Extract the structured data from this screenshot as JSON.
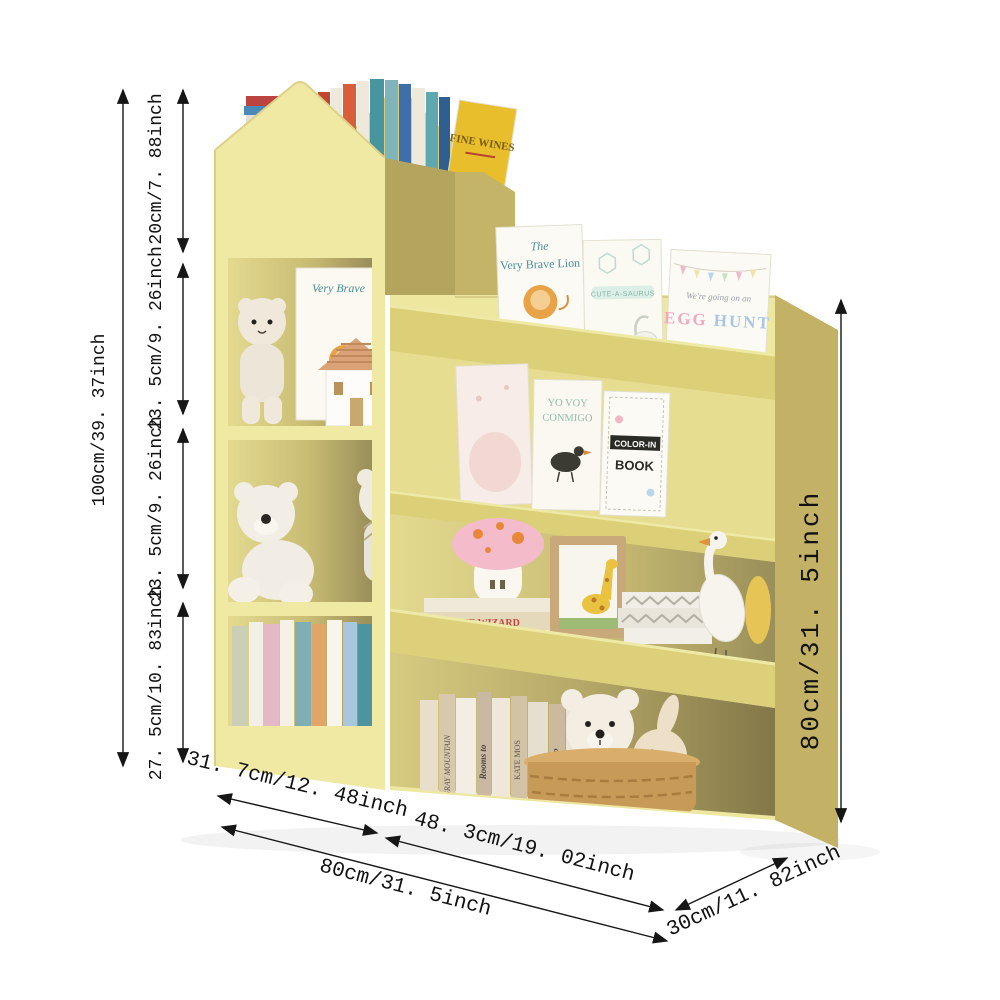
{
  "image": {
    "kind": "kids bookshelf product dimension illustration",
    "background": "#ffffff"
  },
  "colors": {
    "shelf_front": "#EFE9A4",
    "shelf_lip": "#DBCF78",
    "shelf_side": "#C3B166",
    "cubby_shadow": "#9A8E5A",
    "dimension_line": "#161616"
  },
  "dimensions": {
    "left_total_height": "100cm/39. 37inch",
    "top_section_height": "20cm/7. 88inch",
    "upper_shelf_height": "23. 5cm/9. 26inch",
    "middle_shelf_height": "23. 5cm/9. 26inch",
    "bottom_shelf_height": "27. 5cm/10. 83inch",
    "left_unit_width": "31. 7cm/12. 48inch",
    "right_unit_width": "48. 3cm/19. 02inch",
    "total_width": "80cm/31. 5inch",
    "right_unit_height": "80cm/31. 5inch",
    "depth": "30cm/11. 82inch"
  },
  "books": {
    "attic_title": "FINE WINES",
    "cubby1_book_title": "Very Brave",
    "tier1_book1_line1": "The",
    "tier1_book1_line2": "Very Brave Lion",
    "tier1_book2_banner": "CUTE-A-SAURUS",
    "tier1_book3_line1": "We're going on an",
    "tier1_book3_word1": "EGG",
    "tier1_book3_word2": "HUNT",
    "tier2_book2_line1": "YO VOY",
    "tier2_book2_line2": "CONMIGO",
    "tier2_book3_line1": "COLOR-IN",
    "tier2_book3_line2": "BOOK",
    "wizard_spine": "THE WIZARD",
    "spine_rooms": "Rooms to",
    "spine_kate": "KATE MOS",
    "spine_gray": "GRAY MOUNTAIN"
  }
}
